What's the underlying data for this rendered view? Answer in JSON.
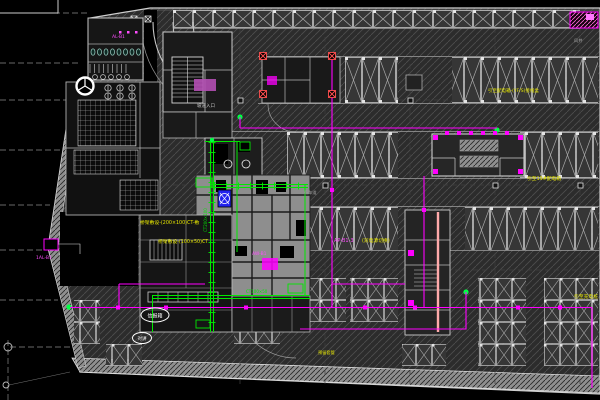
{
  "drawing": {
    "type": "cad-floor-plan",
    "description": "Basement garage electrical plan, dark CAD canvas",
    "colors": {
      "background": "#000000",
      "floor_hatch": "#4e4e4e",
      "stall_line": "#c4c4c4",
      "cable_tray_green": "#00e800",
      "wiring_magenta": "#ff00ff",
      "note_yellow": "#e6e600",
      "equipment_blue": "#2222ee",
      "alarm_red": "#ff5050",
      "pink_riser": "#ffaaaa"
    },
    "notes": {
      "n1": "桥架敷设-(200×100)CT-敷",
      "n2": "桥架敷设-(100×50)CT",
      "n3": "引至配电箱-(YF/S)接线盒",
      "n4": "引至19#配电箱",
      "n5": "(双电源切换)",
      "n6": "引至充电桩",
      "n7": "预留套管"
    },
    "labels": {
      "panel_1": "AL-B1",
      "panel_2": "AW-B1",
      "panel_3": "AP-B1-3",
      "panel_4": "1AL-B1",
      "ramp": "坡道入口",
      "lane": "行车道",
      "shaft": "风井",
      "tray_1": "CT200×100",
      "tray_2": "CT100×50"
    },
    "clouds": {
      "c1": "信报箱",
      "c2": "对讲"
    }
  }
}
